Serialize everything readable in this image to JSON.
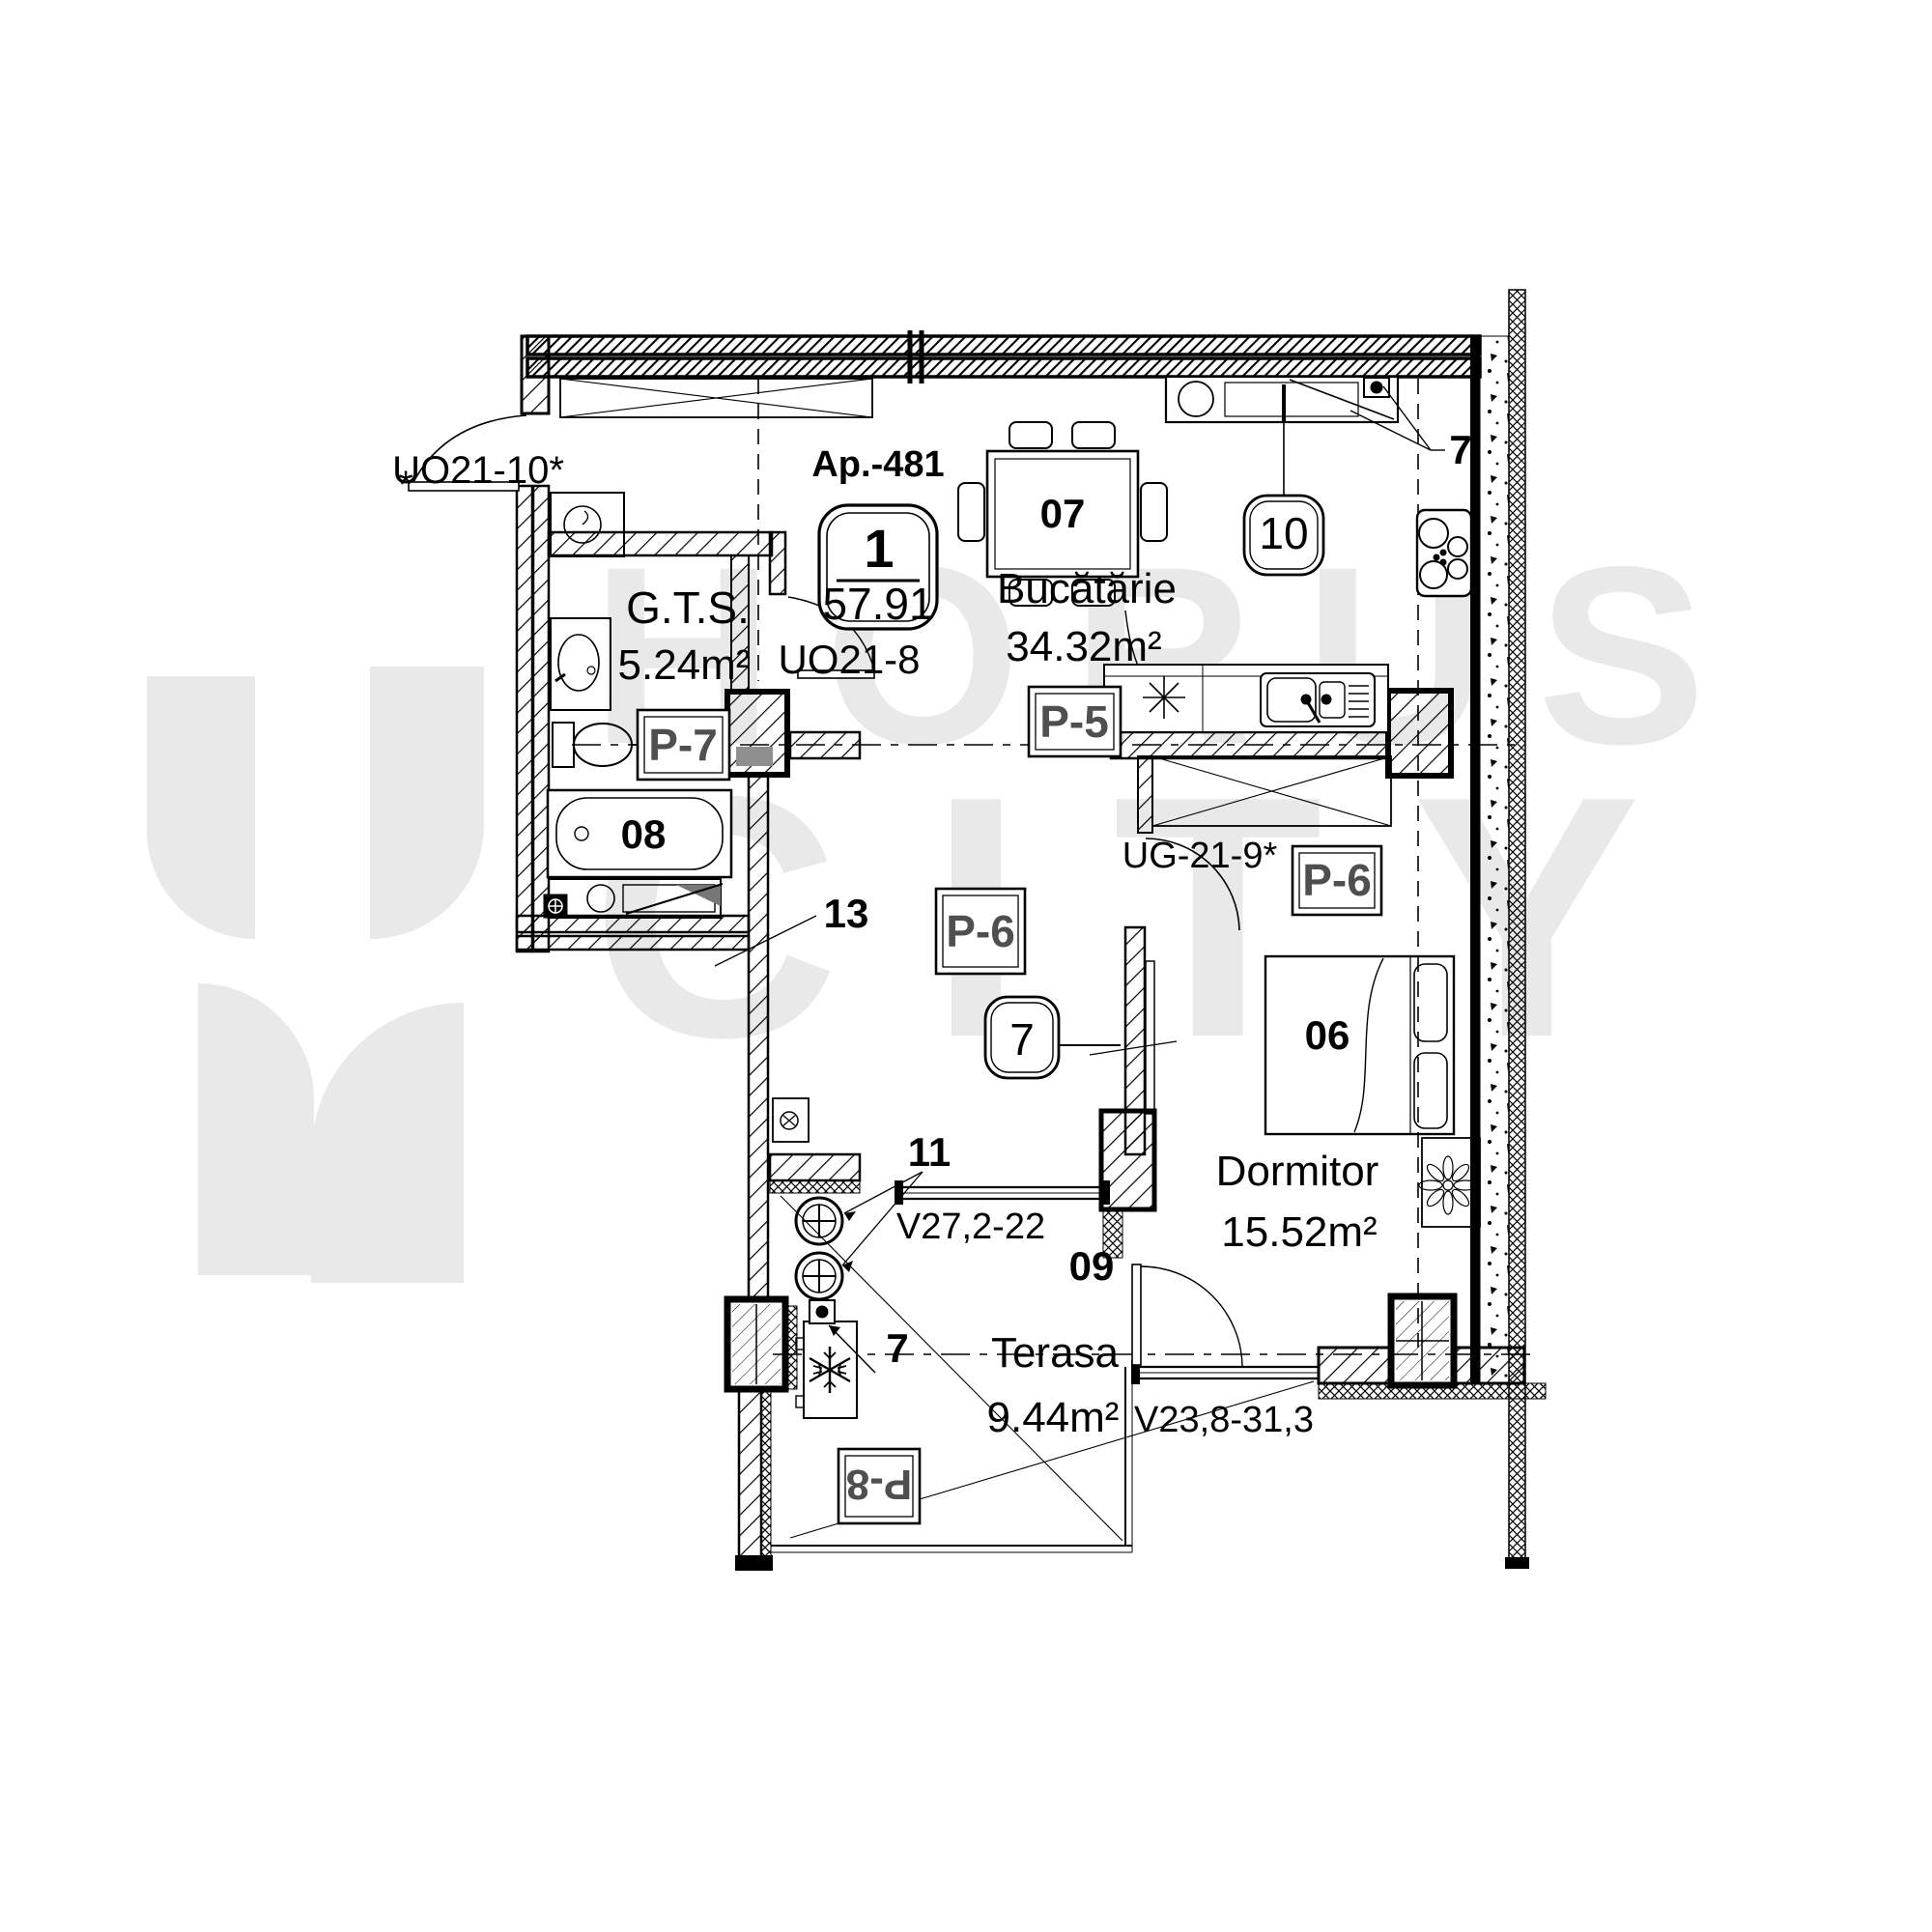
{
  "watermark": {
    "brand_top": "HORUS",
    "brand_bottom": "CITY"
  },
  "apartment": {
    "label": "Ap.-481",
    "unit": "1",
    "area_total": "57.91"
  },
  "labels": {
    "gts_name": "G.T.S.",
    "gts_area": "5.24m²",
    "kitchen_name": "Bucătărie",
    "kitchen_area": "34.32m²",
    "bedroom_name": "Dormitor",
    "bedroom_area": "15.52m²",
    "terrace_name": "Terasa",
    "terrace_area": "9.44m²"
  },
  "codes": {
    "entry_door": "UO21-10*",
    "entry_asterisk": "*",
    "hall_door": "UO21-8",
    "bedroom_door": "UG-21-9*",
    "hall_window": "V27,2-22",
    "terrace_window": "V23,8-31,3"
  },
  "badges": {
    "p5": "P-5",
    "p6_hall": "P-6",
    "p6_bedroom": "P-6",
    "p7": "P-7",
    "p8": "P-8",
    "circle_7": "7",
    "circle_10": "10"
  },
  "tags": {
    "bed": "06",
    "dining": "07",
    "bathtub": "08",
    "hall": "09",
    "vents": "11",
    "corridor": "13",
    "kitchen_corner": "7",
    "terrace_unit": "7"
  },
  "colors": {
    "ink": "#000000",
    "badge_text": "#4f4f4f",
    "watermark": "#e9e9e9",
    "paper": "#ffffff"
  }
}
